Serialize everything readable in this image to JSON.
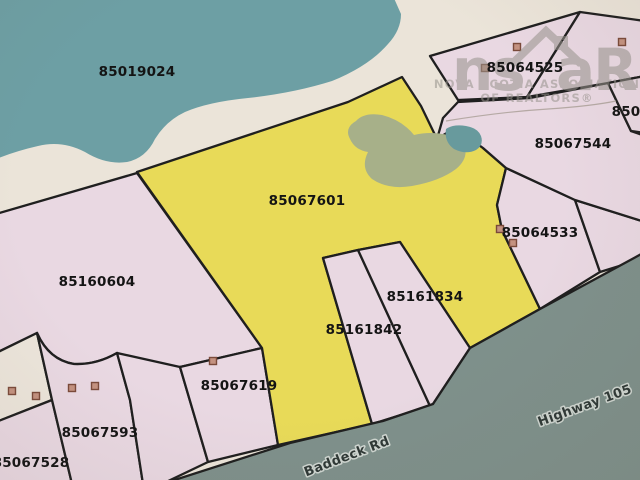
{
  "map": {
    "colors": {
      "background": "#ebe4d9",
      "water": "#6d9fa4",
      "pond": "#689a9d",
      "pink": "#e9d8e2",
      "yellow": "#e8da58",
      "cream": "#ece5db",
      "wetland": "#a7b089",
      "road": "#7e908b",
      "boundary": "#1f1f1f",
      "label_text": "#141414",
      "road_label_text": "#2e3836",
      "road_label_halo": "#cfd6d1",
      "building_fill": "#c49280",
      "building_stroke": "#7a4a3a",
      "stream": "#b5a9a4",
      "watermark": "#97938c"
    },
    "water": {
      "label": "85019024",
      "label_pos": [
        137,
        72
      ],
      "path": "M-4,-4 L393,-4 L401,14 Q401,30 388,44 Q369,66 332,81 Q294,93 248,98 Q208,102 185,112 Q166,121 155,139 Q146,158 127,162 Q106,165 85,152 Q62,140 38,146 Q16,151 -4,159 Z"
    },
    "parcels": [
      {
        "id": "85160604",
        "fill": "pink",
        "path": "M-4,214 L137,173 L262,348 L180,367 Q148,374 117,353 Q96,365 74,364 Q49,360 37,333 L-4,353 Z"
      },
      {
        "id": "unshaded-wedge",
        "fill": "cream",
        "path": "M-4,353 L37,333 L52,400 L-4,422 Z"
      },
      {
        "id": "85067528",
        "fill": "pink",
        "path": "M-4,422 L52,400 L72,484 L-4,484 Z"
      },
      {
        "id": "85067593",
        "fill": "pink",
        "path": "M37,333 Q49,360 74,364 Q96,365 117,353 L130,400 L143,484 L72,484 L52,400 Z"
      },
      {
        "id": "strip-unlabeled",
        "fill": "pink",
        "path": "M117,353 L180,367 L208,462 L162,484 L143,484 L130,400 Z"
      },
      {
        "id": "85067619",
        "fill": "pink",
        "path": "M180,367 L262,348 L278,445 L208,462 Z"
      },
      {
        "id": "85067601",
        "fill": "yellow",
        "path": "M137,172 L348,102 L402,77 L421,106 L437,139 L450,131 L468,137 L483,148 L506,168 L497,205 L502,230 L540,309 L470,348 L400,242 L358,250 L323,258 L372,424 L278,445 L262,348 Z"
      },
      {
        "id": "85161842",
        "fill": "pink",
        "path": "M323,258 L358,250 L430,406 L372,424 Z"
      },
      {
        "id": "85161834",
        "fill": "pink",
        "path": "M358,250 L400,242 L470,348 L433,404 L430,406 Z"
      },
      {
        "id": "85064533",
        "fill": "pink",
        "path": "M506,168 L575,200 L600,272 L540,309 L502,230 L497,205 Z"
      },
      {
        "id": "parcel-right-sliver",
        "fill": "pink",
        "path": "M575,200 L645,222 L645,258 L600,272 Z"
      },
      {
        "id": "85067544",
        "fill": "pink",
        "path": "M458,102 L530,98 L608,83 L631,131 L645,136 L645,222 L575,200 L506,168 L483,148 L468,137 L450,131 L437,139 L443,118 Z"
      },
      {
        "id": "85064525",
        "fill": "pink",
        "path": "M430,56 L580,12 L527,97 L458,100 Z"
      },
      {
        "id": "parcel-ne-corner",
        "fill": "pink",
        "path": "M580,12 L645,21 L645,76 L608,83 L527,97 Z"
      },
      {
        "id": "850-partial",
        "fill": "pink",
        "path": "M608,83 L645,76 L645,133 L631,131 Z"
      }
    ],
    "features": [
      {
        "id": "wetland",
        "fill": "wetland",
        "path": "M356,121 Q344,128 350,139 Q355,150 368,152 Q360,168 372,179 Q388,190 412,186 Q440,181 456,169 Q468,159 465,147 Q462,137 448,135 Q430,131 414,135 Q402,120 382,115 Q364,112 356,121 Z"
      },
      {
        "id": "pond",
        "fill": "pond",
        "path": "M446,129 Q444,142 454,149 Q466,155 476,150 Q484,145 481,136 Q478,128 466,126 Q453,124 446,129 Z"
      }
    ],
    "road": {
      "path": "M162,484 L290,443 L383,421 L433,404 L470,348 L540,309 L645,252 L645,484 Z"
    },
    "stream_path": "M446,121 Q500,112 548,109 Q592,106 616,101",
    "parcel_labels": [
      {
        "text": "85019024",
        "x": 137,
        "y": 72
      },
      {
        "text": "85064525",
        "x": 525,
        "y": 68
      },
      {
        "text": "850",
        "x": 626,
        "y": 112
      },
      {
        "text": "85067544",
        "x": 573,
        "y": 144
      },
      {
        "text": "85067601",
        "x": 307,
        "y": 201
      },
      {
        "text": "85064533",
        "x": 540,
        "y": 233
      },
      {
        "text": "85160604",
        "x": 97,
        "y": 282
      },
      {
        "text": "85161834",
        "x": 425,
        "y": 297
      },
      {
        "text": "85161842",
        "x": 364,
        "y": 330
      },
      {
        "text": "85067619",
        "x": 239,
        "y": 386
      },
      {
        "text": "85067593",
        "x": 100,
        "y": 433
      },
      {
        "text": "85067528",
        "x": 31,
        "y": 463
      }
    ],
    "road_labels": [
      {
        "text": "Baddeck Rd",
        "x": 347,
        "y": 457,
        "rotation": -21
      },
      {
        "text": "Highway 105",
        "x": 585,
        "y": 406,
        "rotation": -20
      }
    ],
    "buildings": [
      [
        517,
        47
      ],
      [
        485,
        68
      ],
      [
        622,
        42
      ],
      [
        500,
        229
      ],
      [
        513,
        243
      ],
      [
        213,
        361
      ],
      [
        72,
        388
      ],
      [
        95,
        386
      ],
      [
        12,
        391
      ],
      [
        36,
        396
      ]
    ],
    "watermark": {
      "logo_left": "ns",
      "logo_right": "aR",
      "line1": "NOVA SCOTIA ASSOCIATION",
      "line2": "OF REALTORS®"
    }
  }
}
